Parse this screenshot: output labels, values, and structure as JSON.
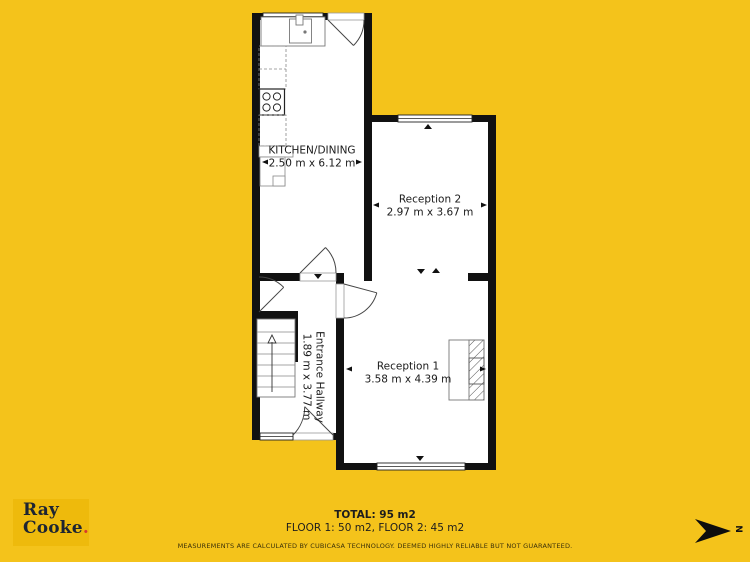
{
  "plan": {
    "rooms": [
      {
        "name": "KITCHEN/DINING",
        "dimensions": "2.50 m x 6.12 m"
      },
      {
        "name": "Reception 2",
        "dimensions": "2.97 m x 3.67 m"
      },
      {
        "name": "Entrance Hallway",
        "dimensions": "1.89 m x 3.77 m"
      },
      {
        "name": "Reception 1",
        "dimensions": "3.58 m x 4.39 m"
      }
    ]
  },
  "footer": {
    "total": "TOTAL: 95 m2",
    "floors": "FLOOR 1: 50 m2, FLOOR 2: 45 m2",
    "disclaimer": "MEASUREMENTS ARE CALCULATED BY CUBICASA TECHNOLOGY. DEEMED HIGHLY RELIABLE BUT NOT GUARANTEED."
  },
  "logo": {
    "line1": "Ray",
    "line2": "Cooke",
    "period": "."
  },
  "compass": {
    "label": "N"
  },
  "colors": {
    "background": "#F4C31B",
    "wall": "#111111",
    "floor": "#FFFFFF",
    "logo_text": "#1D2532",
    "logo_period": "#D8392C"
  }
}
